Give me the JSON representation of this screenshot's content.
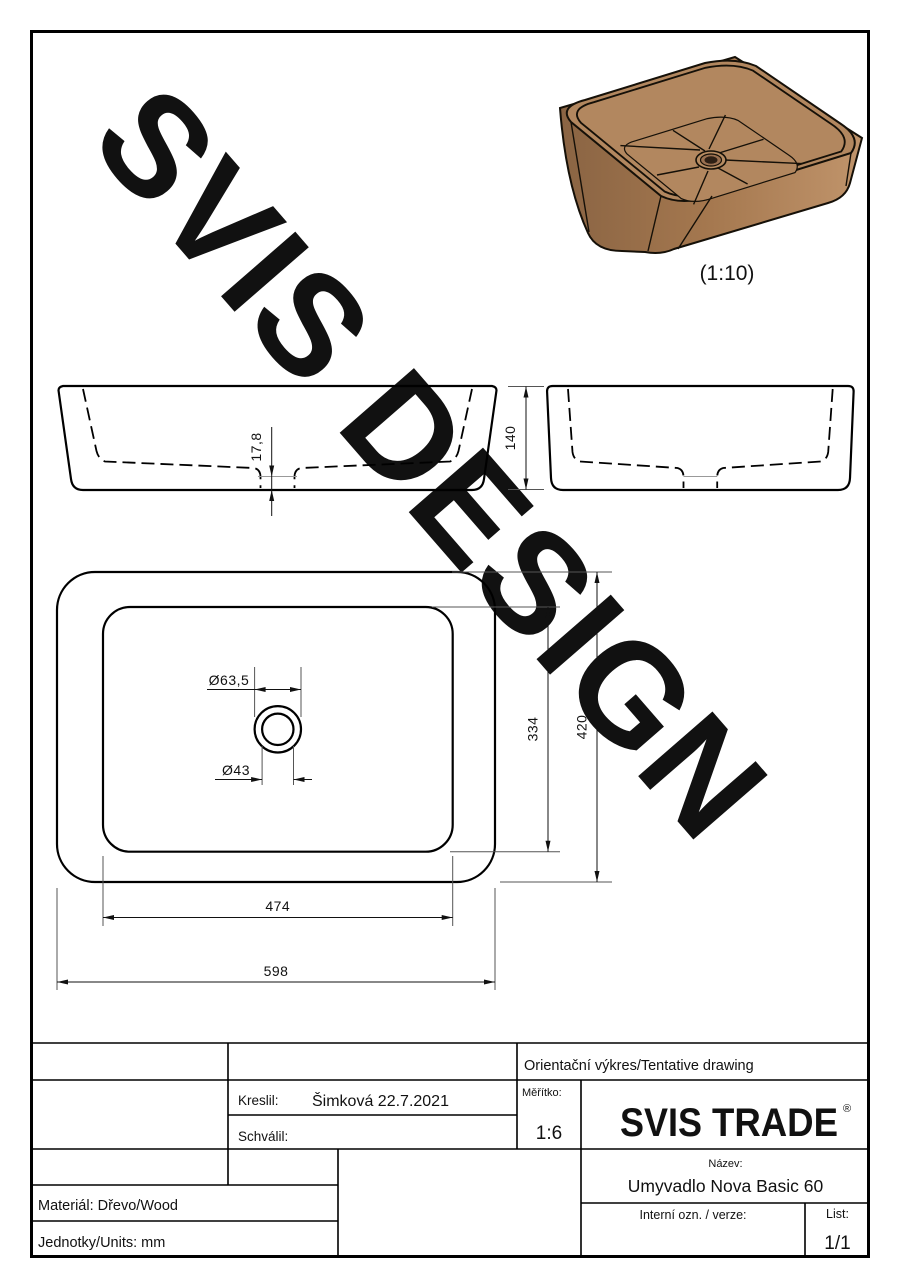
{
  "watermark": "SVIS DESIGN",
  "iso": {
    "scale_label": "(1:10)"
  },
  "dimensions": {
    "front_recess_depth": "17,8",
    "side_height": "140",
    "drain_outer_dia": "Ø63,5",
    "drain_inner_dia": "Ø43",
    "inner_width": "334",
    "outer_width": "420",
    "inner_length": "474",
    "outer_length": "598"
  },
  "title_block": {
    "tentative": "Orientační výkres/Tentative drawing",
    "kreslil_label": "Kreslil:",
    "kreslil_value": "Šimková 22.7.2021",
    "schvalil_label": "Schválil:",
    "meritko_label": "Měřítko:",
    "meritko_value": "1:6",
    "logo_svis": "SVIS",
    "logo_trade": "TRADE",
    "logo_reg": "®",
    "nazev_label": "Název:",
    "nazev_value": "Umyvadlo Nova Basic 60",
    "material": "Materiál: Dřevo/Wood",
    "units": "Jednotky/Units: mm",
    "interni_label": "Interní ozn. / verze:",
    "list_label": "List:",
    "list_value": "1/1"
  },
  "colors": {
    "trade_accent": "#F9B115",
    "watermark_light": "#e0e0e0",
    "watermark_dark": "#a8a8a8",
    "wood_dark": "#8a6443",
    "wood_mid": "#b2875f",
    "wood_light": "#c9a077"
  }
}
